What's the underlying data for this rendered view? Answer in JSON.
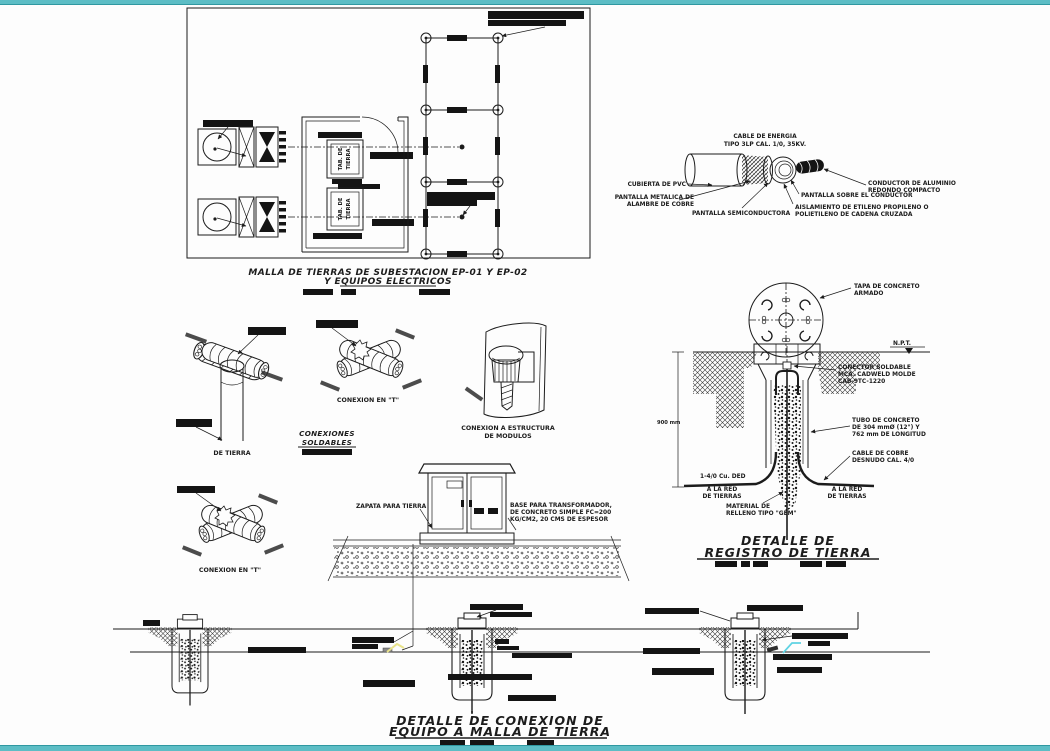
{
  "colors": {
    "frame_teal": "#5cbdc5",
    "frame_teal_dark": "#2f98a1",
    "highlight_yellow": "#e9e48b",
    "highlight_cyan": "#5fd3e3"
  },
  "plan": {
    "title_line1": "MALLA DE TIERRAS DE SUBESTACION EP-01 Y EP-02",
    "title_line2": "Y EQUIPOS ELECTRICOS",
    "tab_board_line1": "TAB. DE",
    "tab_board_line2": "TIERRA"
  },
  "cable_detail": {
    "title_line1": "CABLE DE ENERGIA",
    "title_line2": "TIPO 3LP CAL. 1/0, 35KV.",
    "jacket_label": "CUBIERTA DE PVC",
    "metal_screen_line1": "PANTALLA METALICA DE",
    "metal_screen_line2": "ALAMBRE DE COBRE",
    "semiconductor_label": "PANTALLA SEMICONDUCTORA",
    "conductor_line1": "CONDUCTOR DE ALUMINIO",
    "conductor_line2": "REDONDO COMPACTO",
    "shield_label": "PANTALLA SOBRE EL CONDUCTOR",
    "insulation_line1": "AISLAMIENTO DE ETILENO PROPILENO O",
    "insulation_line2": "POLIETILENO DE CADENA CRUZADA"
  },
  "welded_connections": {
    "rod_label": "DE TIERRA",
    "t_connection_label": "CONEXION EN \"T\"",
    "t_connection2_label": "CONEXION EN \"T\"",
    "group_title_line1": "CONEXIONES",
    "group_title_line2": "SOLDABLES",
    "module_title_line1": "CONEXION A ESTRUCTURA",
    "module_title_line2": "DE MODULOS"
  },
  "cabinet_detail": {
    "zapata_label": "ZAPATA PARA TIERRA",
    "base_line1": "BASE PARA TRANSFORMADOR,",
    "base_line2": "DE CONCRETO SIMPLE FC=200",
    "base_line3": "KG/CM2, 20 CMS DE ESPESOR"
  },
  "registro_detail": {
    "tapa_line1": "TAPA DE CONCRETO",
    "tapa_line2": "ARMADO",
    "npt_label": "N.P.T.",
    "depth_dim": "900 mm",
    "conector_line1": "CONECTOR SOLDABLE",
    "conector_line2": "MCA. CADWELD MOLDE",
    "conector_line3": "CAB-9TC-1220",
    "tubo_line1": "TUBO DE CONCRETO",
    "tubo_line2": "DE 304 mmØ (12\") Y",
    "tubo_line3": "762 mm DE LONGITUD",
    "cable_line1": "CABLE DE COBRE",
    "cable_line2": "DESNUDO CAL. 4/0",
    "cable_run_label": "1-4/0 Cu. DED",
    "left_net_line1": "A LA RED",
    "left_net_line2": "DE TIERRAS",
    "right_net_line1": "A LA RED",
    "right_net_line2": "DE TIERRAS",
    "relleno_line1": "MATERIAL DE",
    "relleno_line2": "RELLENO TIPO \"GEM\"",
    "title_line1": "DETALLE DE",
    "title_line2": "REGISTRO DE TIERRA"
  },
  "bottom_detail": {
    "title_line1": "DETALLE DE CONEXION DE",
    "title_line2": "EQUIPO A MALLA DE TIERRA"
  }
}
